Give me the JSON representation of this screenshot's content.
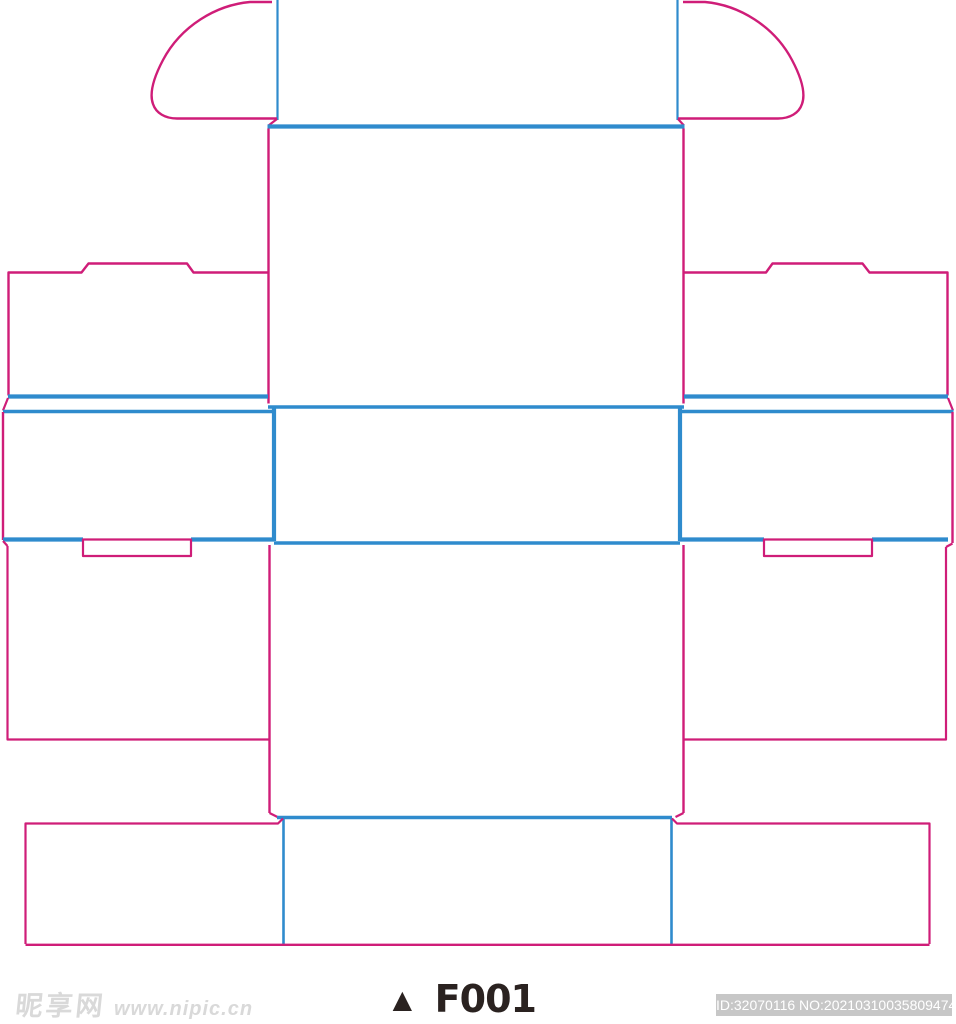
{
  "colors": {
    "page_bg": "#ffffff",
    "cut_line": "#cf1d78",
    "fold_line": "#2f8bcd",
    "label_text": "#2a2220",
    "watermark": "#d9d9d9",
    "id_badge_bg": "#c7c7c7",
    "id_badge_text": "#ffffff"
  },
  "diagram": {
    "kind": "packaging dieline (box die-cut template)",
    "template_code": "F001"
  },
  "footer": {
    "watermark_logo": "昵享网",
    "watermark_url": "www.nipic.cn",
    "label_marker": "▲",
    "label_text": "F001",
    "id_text": "ID:32070116 NO:20210310035809474037"
  }
}
